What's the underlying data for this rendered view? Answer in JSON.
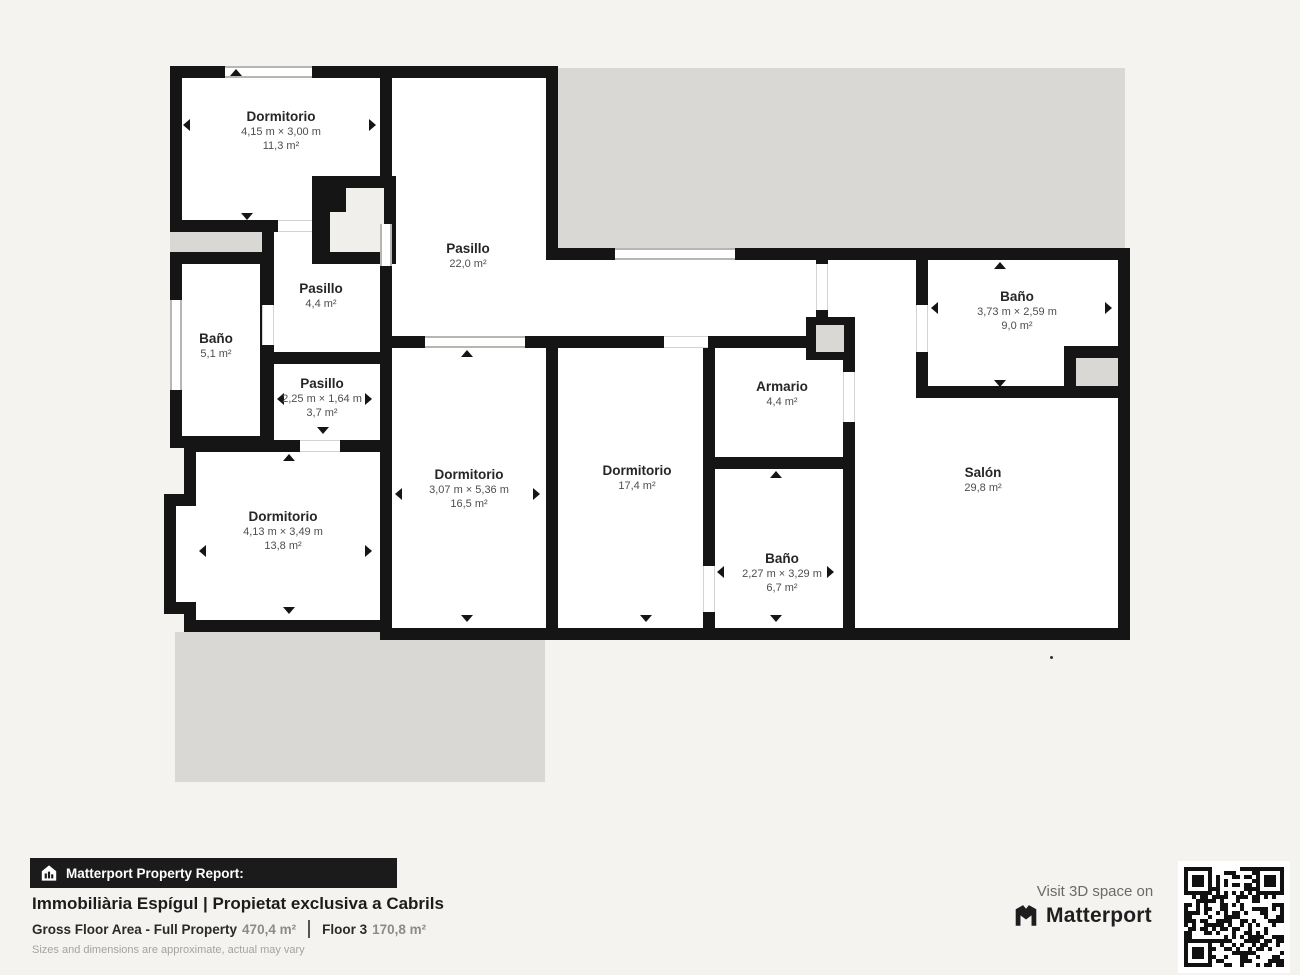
{
  "rooms": [
    {
      "id": "dormitorio-nw",
      "name": "Dormitorio",
      "dimensions": "4,15 m × 3,00 m",
      "area": "11,3 m²"
    },
    {
      "id": "pasillo-grande",
      "name": "Pasillo",
      "area": "22,0 m²"
    },
    {
      "id": "pasillo-medio",
      "name": "Pasillo",
      "area": "4,4 m²"
    },
    {
      "id": "bano-oeste",
      "name": "Baño",
      "area": "5,1 m²"
    },
    {
      "id": "pasillo-pequeno",
      "name": "Pasillo",
      "dimensions": "2,25 m × 1,64 m",
      "area": "3,7 m²"
    },
    {
      "id": "dormitorio-sw",
      "name": "Dormitorio",
      "dimensions": "4,13 m × 3,49 m",
      "area": "13,8 m²"
    },
    {
      "id": "dormitorio-centro",
      "name": "Dormitorio",
      "dimensions": "3,07 m × 5,36 m",
      "area": "16,5 m²"
    },
    {
      "id": "dormitorio-este",
      "name": "Dormitorio",
      "area": "17,4 m²"
    },
    {
      "id": "armario",
      "name": "Armario",
      "area": "4,4 m²"
    },
    {
      "id": "bano-centro",
      "name": "Baño",
      "dimensions": "2,27 m × 3,29 m",
      "area": "6,7 m²"
    },
    {
      "id": "bano-ne",
      "name": "Baño",
      "dimensions": "3,73 m × 2,59 m",
      "area": "9,0 m²"
    },
    {
      "id": "salon",
      "name": "Salón",
      "area": "29,8 m²"
    }
  ],
  "footer": {
    "report_label": "Matterport Property Report:",
    "title": "Immobiliària Espígul | Propietat exclusiva a Cabrils",
    "gross_label": "Gross Floor Area - Full Property",
    "gross_value": "470,4 m²",
    "floor_label": "Floor 3",
    "floor_value": "170,8 m²",
    "disclaimer": "Sizes and dimensions are approximate, actual may vary"
  },
  "cta": {
    "visit": "Visit 3D space on",
    "brand": "Matterport"
  },
  "watermark": {
    "brand": "ESPIGUL",
    "line1": "REAL ESTATE",
    "line2": "GROUP"
  },
  "colors": {
    "wall": "#151515",
    "terrace": "#d9d8d5",
    "page_bg": "#f4f3f0"
  },
  "icons": {
    "report_icon": "house-chart-icon",
    "brand_icon": "matterport-m-icon",
    "qr": "qr-code"
  }
}
